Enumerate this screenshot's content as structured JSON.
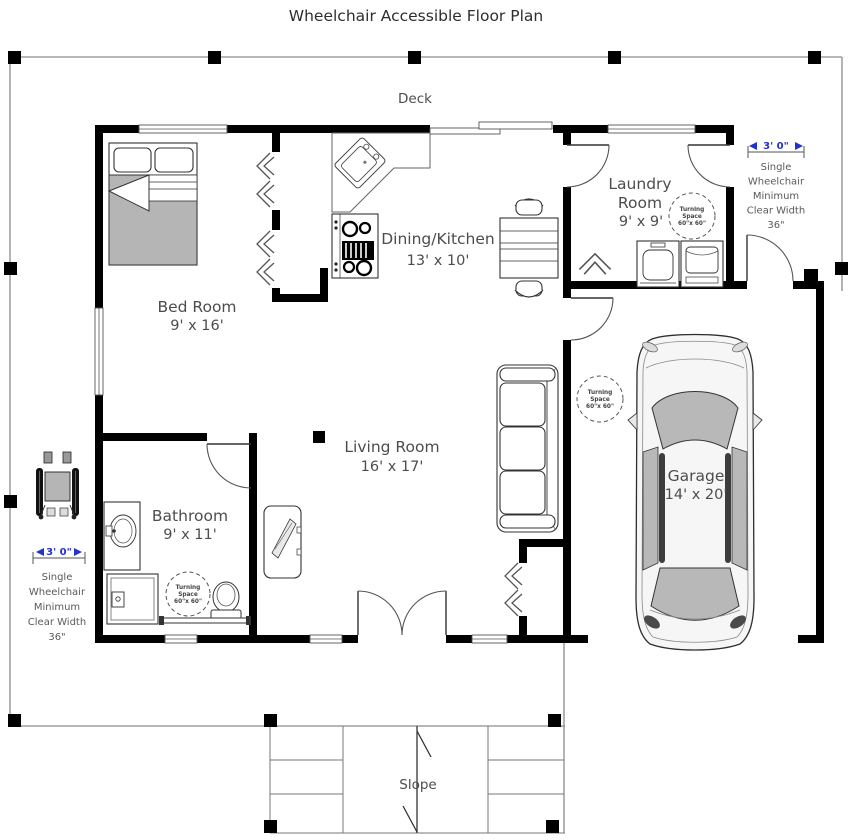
{
  "title": "Wheelchair Accessible Floor Plan",
  "deck_label": "Deck",
  "slope_label": "Slope",
  "rooms": {
    "bedroom": {
      "name": "Bed Room",
      "dims": "9' x 16'"
    },
    "dining_kitchen": {
      "name": "Dining/Kitchen",
      "dims": "13' x 10'"
    },
    "laundry": {
      "name_line1": "Laundry",
      "name_line2": "Room",
      "dims": "9' x 9'"
    },
    "living": {
      "name": "Living Room",
      "dims": "16' x 17'"
    },
    "bathroom": {
      "name": "Bathroom",
      "dims": "9' x 11'"
    },
    "garage": {
      "name": "Garage",
      "dims": "14' x 20'"
    }
  },
  "turning_space": {
    "line1": "Turning",
    "line2": "Space",
    "line3": "60\"x 60\""
  },
  "clearance_note": {
    "dimension": "3' 0\"",
    "lines": [
      "Single",
      "Wheelchair",
      "Minimum",
      "Clear Width",
      "36\""
    ]
  },
  "colors": {
    "wall": "#000000",
    "deck_line": "#8c8c8c",
    "label_text": "#4d4d4d",
    "dimension_text": "#2233cc",
    "blanket_gray": "#b5b5b5"
  }
}
